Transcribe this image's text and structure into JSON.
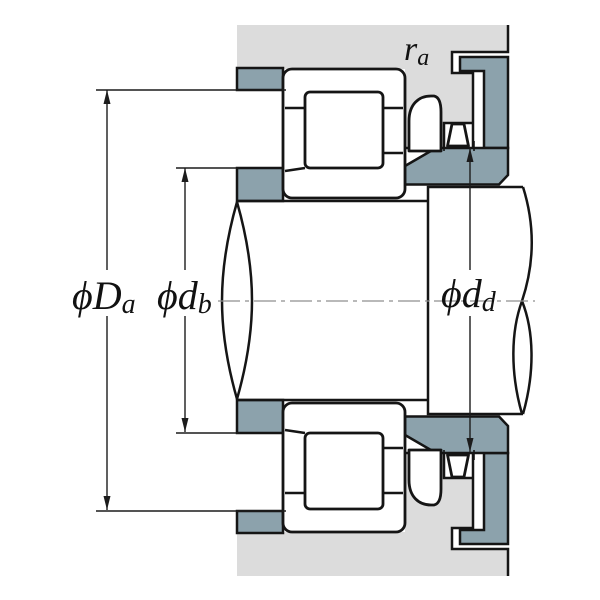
{
  "title": "Bearing mounting cross-section diagram",
  "colors": {
    "background": "#ffffff",
    "housing_fill": "#dcdcdc",
    "abutment_steel_fill": "#8ca2ac",
    "outline": "#151515",
    "dimension_line": "#1c1c1c",
    "centerline": "#8f8f8f",
    "part_fill": "#ffffff"
  },
  "labels": {
    "fillet_radius": {
      "base": "r",
      "sub": "a"
    },
    "housing_abutment_diameter": {
      "base": "ϕD",
      "sub": "a"
    },
    "shaft_abutment_diameter": {
      "base": "ϕd",
      "sub": "b"
    },
    "rib_abutment_diameter": {
      "base": "ϕd",
      "sub": "d"
    }
  }
}
